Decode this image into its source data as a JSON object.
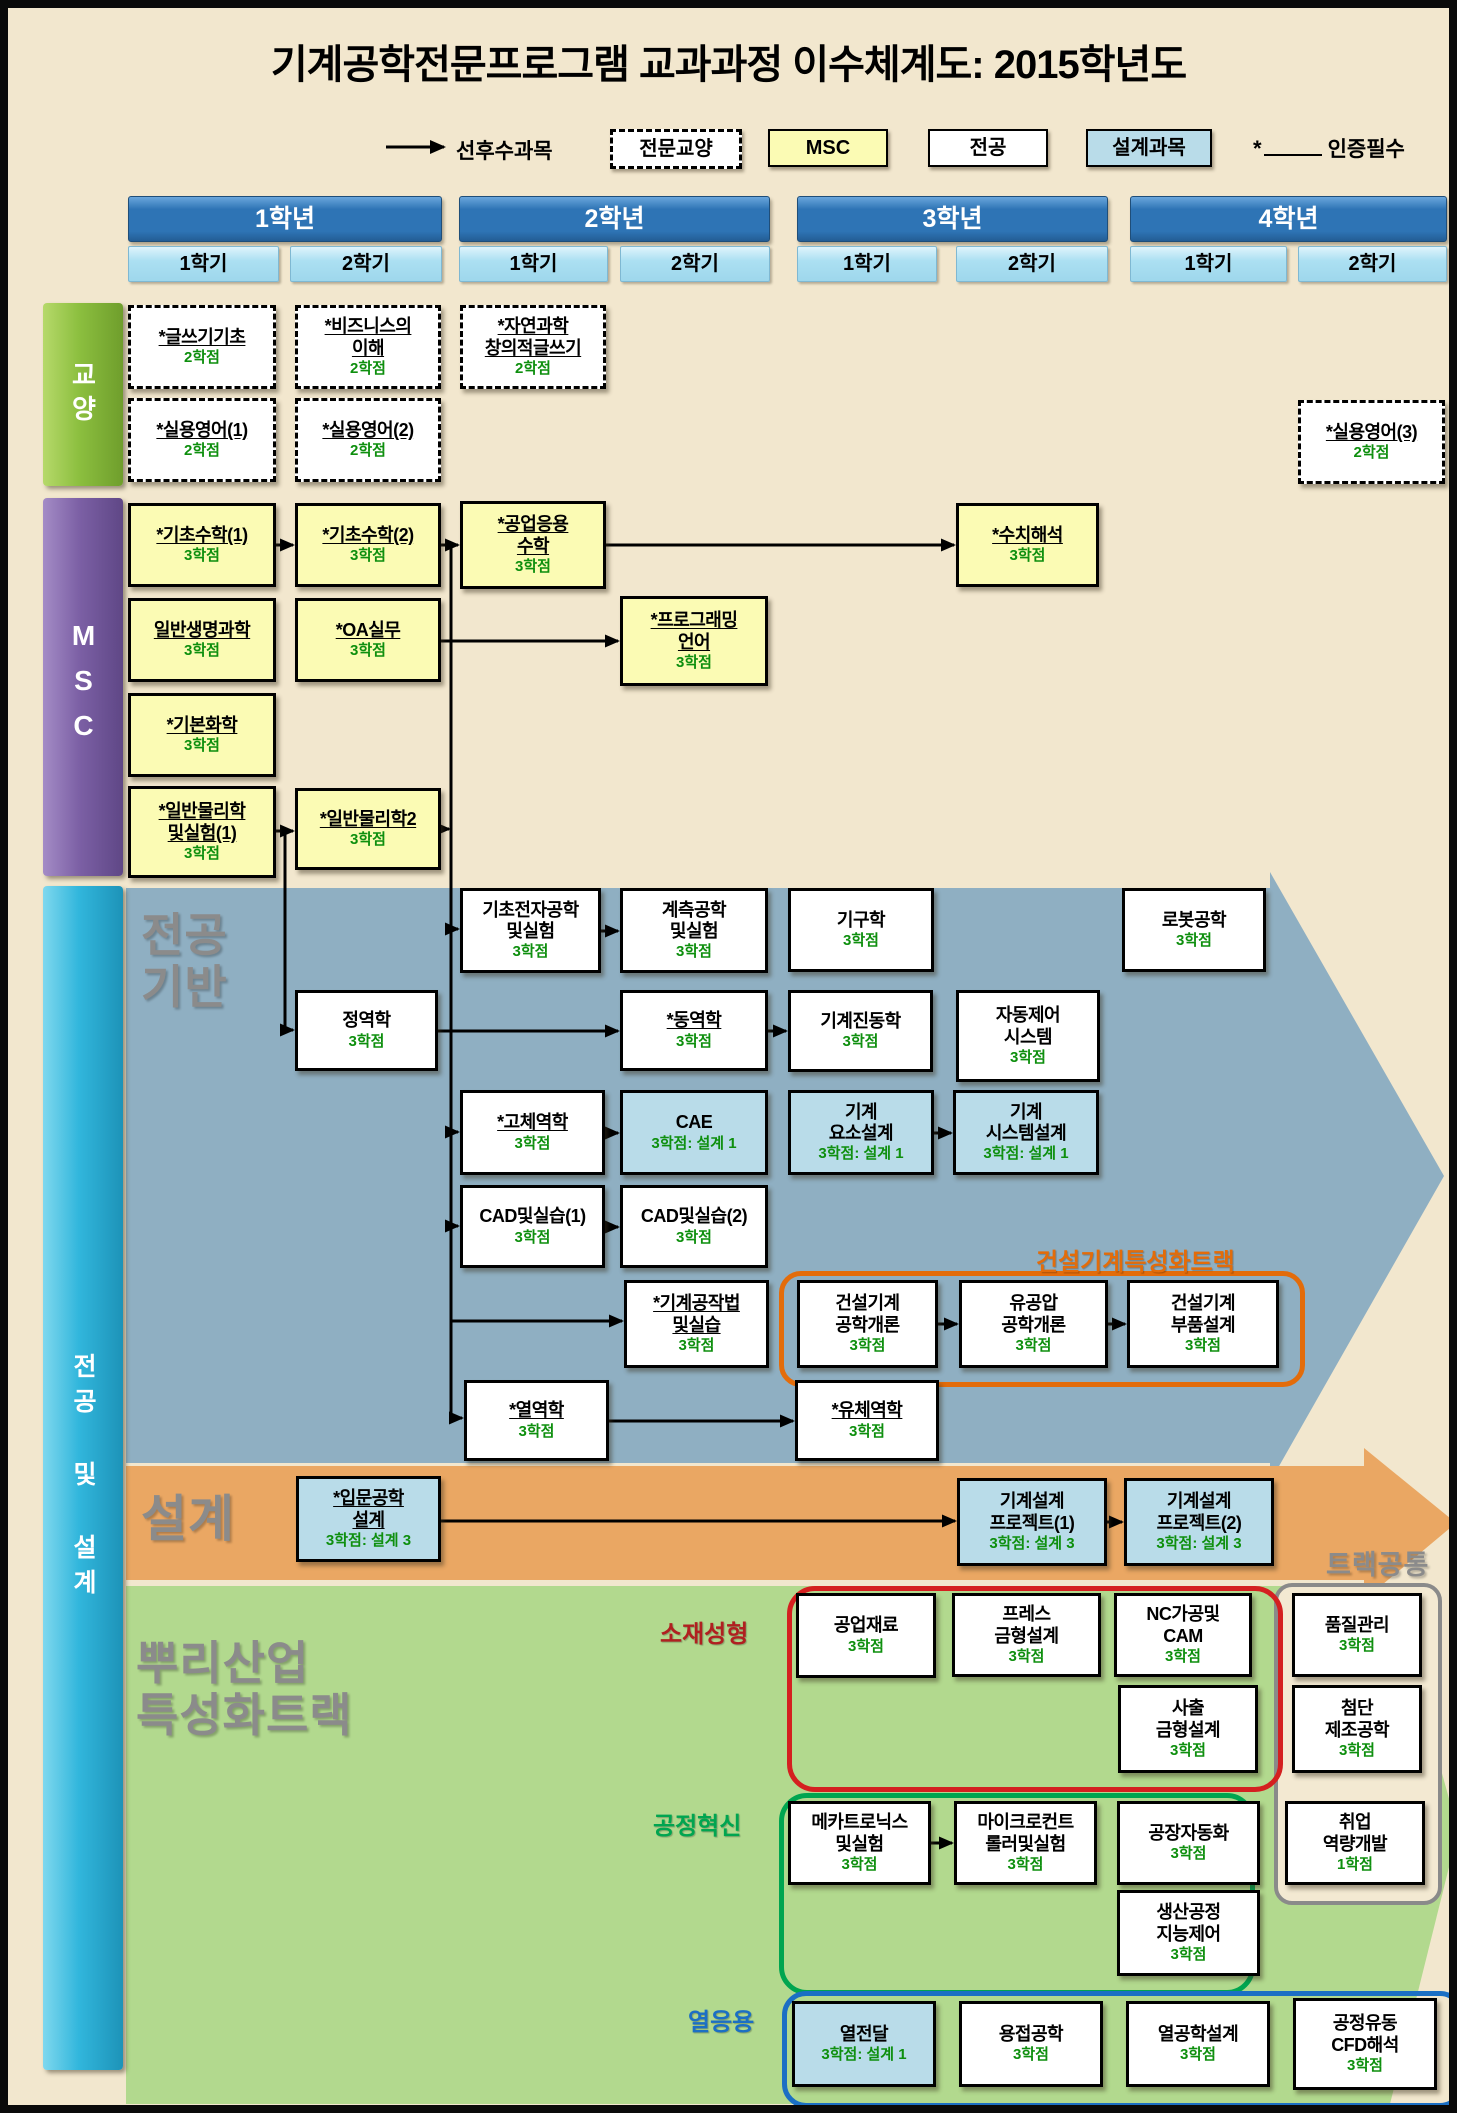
{
  "title": "기계공학전문프로그램 교과과정 이수체계도: 2015학년도",
  "legend": {
    "arrow_label": "선후수과목",
    "items": [
      {
        "id": "ge",
        "label": "전문교양"
      },
      {
        "id": "msc",
        "label": "MSC"
      },
      {
        "id": "major",
        "label": "전공"
      },
      {
        "id": "design",
        "label": "설계과목"
      }
    ],
    "certified_star": "*",
    "certified_label": "인증필수"
  },
  "header": {
    "y": 188,
    "h": 44,
    "sem_y": 238,
    "sem_h": 34,
    "years": [
      {
        "label": "1학년",
        "x": 120,
        "w": 312,
        "semesters": [
          {
            "label": "1학기",
            "x": 120,
            "w": 149
          },
          {
            "label": "2학기",
            "x": 282,
            "w": 150
          }
        ]
      },
      {
        "label": "2학년",
        "x": 451,
        "w": 309,
        "semesters": [
          {
            "label": "1학기",
            "x": 451,
            "w": 147
          },
          {
            "label": "2학기",
            "x": 612,
            "w": 148
          }
        ]
      },
      {
        "label": "3학년",
        "x": 789,
        "w": 309,
        "semesters": [
          {
            "label": "1학기",
            "x": 789,
            "w": 138
          },
          {
            "label": "2학기",
            "x": 948,
            "w": 150
          }
        ]
      },
      {
        "label": "4학년",
        "x": 1122,
        "w": 315,
        "semesters": [
          {
            "label": "1학기",
            "x": 1122,
            "w": 155
          },
          {
            "label": "2학기",
            "x": 1290,
            "w": 147
          }
        ]
      }
    ]
  },
  "sidebar": [
    {
      "id": "ge",
      "label": "교양",
      "x": 35,
      "y": 295,
      "h": 183
    },
    {
      "id": "msc",
      "label": "MSC",
      "x": 35,
      "y": 490,
      "h": 378
    },
    {
      "id": "major",
      "label": "전공 및 설계",
      "x": 35,
      "y": 878,
      "h": 1184
    }
  ],
  "section_labels": {
    "major_base": [
      "전공",
      "기반"
    ],
    "design": "설계",
    "root_track": [
      "뿌리산업",
      "특성화트랙"
    ]
  },
  "groups": {
    "const_track": {
      "label": "건설기계특성화트랙",
      "x": 771,
      "y": 1263,
      "w": 516,
      "h": 106,
      "label_x": 1028,
      "label_y": 1234
    },
    "material": {
      "label": "소재성형",
      "x": 779,
      "y": 1578,
      "w": 486,
      "h": 196,
      "label_x": 652,
      "label_y": 1606
    },
    "process": {
      "label": "공정혁신",
      "x": 771,
      "y": 1785,
      "w": 466,
      "h": 192,
      "label_x": 645,
      "label_y": 1798
    },
    "thermal": {
      "label": "열응용",
      "x": 774,
      "y": 1983,
      "w": 672,
      "h": 107,
      "label_x": 680,
      "label_y": 1994
    },
    "common": {
      "label": "트랙공통",
      "x": 1266,
      "y": 1575,
      "w": 160,
      "h": 314,
      "label_x": 1318,
      "label_y": 1542
    }
  },
  "courses": [
    {
      "id": "writing",
      "type": "ge",
      "cert": true,
      "name": [
        "*글쓰기기초"
      ],
      "credit": "2학점",
      "x": 120,
      "y": 297,
      "w": 148,
      "h": 84
    },
    {
      "id": "business",
      "type": "ge",
      "cert": true,
      "name": [
        "*비즈니스의",
        "이해"
      ],
      "credit": "2학점",
      "x": 287,
      "y": 297,
      "w": 146,
      "h": 84
    },
    {
      "id": "sciwriting",
      "type": "ge",
      "cert": true,
      "name": [
        "*자연과학",
        "창의적글쓰기"
      ],
      "credit": "2학점",
      "x": 452,
      "y": 297,
      "w": 146,
      "h": 84
    },
    {
      "id": "eng1",
      "type": "ge",
      "cert": true,
      "name": [
        "*실용영어(1)"
      ],
      "credit": "2학점",
      "x": 120,
      "y": 390,
      "w": 148,
      "h": 84
    },
    {
      "id": "eng2",
      "type": "ge",
      "cert": true,
      "name": [
        "*실용영어(2)"
      ],
      "credit": "2학점",
      "x": 287,
      "y": 390,
      "w": 146,
      "h": 84
    },
    {
      "id": "eng3",
      "type": "ge",
      "cert": true,
      "name": [
        "*실용영어(3)"
      ],
      "credit": "2학점",
      "x": 1290,
      "y": 392,
      "w": 147,
      "h": 84
    },
    {
      "id": "math1",
      "type": "msc",
      "cert": true,
      "name": [
        "*기초수학(1)"
      ],
      "credit": "3학점",
      "x": 120,
      "y": 495,
      "w": 148,
      "h": 84
    },
    {
      "id": "math2",
      "type": "msc",
      "cert": true,
      "name": [
        "*기초수학(2)"
      ],
      "credit": "3학점",
      "x": 287,
      "y": 495,
      "w": 146,
      "h": 84
    },
    {
      "id": "engmath",
      "type": "msc",
      "cert": true,
      "name": [
        "*공업응용",
        "수학"
      ],
      "credit": "3학점",
      "x": 452,
      "y": 493,
      "w": 146,
      "h": 88
    },
    {
      "id": "numerical",
      "type": "msc",
      "cert": true,
      "name": [
        "*수치해석"
      ],
      "credit": "3학점",
      "x": 948,
      "y": 495,
      "w": 143,
      "h": 84
    },
    {
      "id": "bio",
      "type": "msc",
      "cert": true,
      "name": [
        "일반생명과학"
      ],
      "credit": "3학점",
      "x": 120,
      "y": 590,
      "w": 148,
      "h": 84
    },
    {
      "id": "oa",
      "type": "msc",
      "cert": true,
      "name": [
        "*OA실무"
      ],
      "credit": "3학점",
      "x": 287,
      "y": 590,
      "w": 146,
      "h": 84
    },
    {
      "id": "programming",
      "type": "msc",
      "cert": true,
      "name": [
        "*프로그래밍",
        "언어"
      ],
      "credit": "3학점",
      "x": 612,
      "y": 588,
      "w": 148,
      "h": 90
    },
    {
      "id": "chem",
      "type": "msc",
      "cert": true,
      "name": [
        "*기본화학"
      ],
      "credit": "3학점",
      "x": 120,
      "y": 685,
      "w": 148,
      "h": 84
    },
    {
      "id": "phys1",
      "type": "msc",
      "cert": true,
      "name": [
        "*일반물리학",
        "및실험(1)"
      ],
      "credit": "3학점",
      "x": 120,
      "y": 778,
      "w": 148,
      "h": 92
    },
    {
      "id": "phys2",
      "type": "msc",
      "cert": true,
      "name": [
        "*일반물리학2"
      ],
      "credit": "3학점",
      "x": 287,
      "y": 780,
      "w": 146,
      "h": 82
    },
    {
      "id": "elec",
      "type": "major",
      "cert": false,
      "name": [
        "기초전자공학",
        "및실험"
      ],
      "credit": "3학점",
      "x": 452,
      "y": 880,
      "w": 141,
      "h": 85
    },
    {
      "id": "measure",
      "type": "major",
      "cert": false,
      "name": [
        "계측공학",
        "및실험"
      ],
      "credit": "3학점",
      "x": 612,
      "y": 880,
      "w": 148,
      "h": 85
    },
    {
      "id": "kinematics",
      "type": "major",
      "cert": false,
      "name": [
        "기구학"
      ],
      "credit": "3학점",
      "x": 780,
      "y": 880,
      "w": 146,
      "h": 84
    },
    {
      "id": "robot",
      "type": "major",
      "cert": false,
      "name": [
        "로봇공학"
      ],
      "credit": "3학점",
      "x": 1114,
      "y": 880,
      "w": 144,
      "h": 84
    },
    {
      "id": "statics",
      "type": "major",
      "cert": false,
      "name": [
        "정역학"
      ],
      "credit": "3학점",
      "x": 287,
      "y": 982,
      "w": 143,
      "h": 81
    },
    {
      "id": "dynamics",
      "type": "major",
      "cert": true,
      "name": [
        "*동역학"
      ],
      "credit": "3학점",
      "x": 612,
      "y": 982,
      "w": 148,
      "h": 81
    },
    {
      "id": "vibration",
      "type": "major",
      "cert": false,
      "name": [
        "기계진동학"
      ],
      "credit": "3학점",
      "x": 780,
      "y": 982,
      "w": 145,
      "h": 82
    },
    {
      "id": "autocontrol",
      "type": "major",
      "cert": false,
      "name": [
        "자동제어",
        "시스템"
      ],
      "credit": "3학점",
      "x": 948,
      "y": 982,
      "w": 144,
      "h": 92
    },
    {
      "id": "solid",
      "type": "major",
      "cert": true,
      "name": [
        "*고체역학"
      ],
      "credit": "3학점",
      "x": 452,
      "y": 1082,
      "w": 145,
      "h": 85
    },
    {
      "id": "cae",
      "type": "design",
      "cert": false,
      "name": [
        "CAE"
      ],
      "credit": "3학점: 설계 1",
      "x": 612,
      "y": 1082,
      "w": 148,
      "h": 85
    },
    {
      "id": "elements",
      "type": "design",
      "cert": false,
      "name": [
        "기계",
        "요소설계"
      ],
      "credit": "3학점: 설계 1",
      "x": 780,
      "y": 1082,
      "w": 146,
      "h": 85
    },
    {
      "id": "system",
      "type": "design",
      "cert": false,
      "name": [
        "기계",
        "시스템설계"
      ],
      "credit": "3학점: 설계 1",
      "x": 945,
      "y": 1082,
      "w": 146,
      "h": 85
    },
    {
      "id": "cad1",
      "type": "major",
      "cert": false,
      "name": [
        "CAD및실습(1)"
      ],
      "credit": "3학점",
      "x": 452,
      "y": 1177,
      "w": 145,
      "h": 83
    },
    {
      "id": "cad2",
      "type": "major",
      "cert": false,
      "name": [
        "CAD및실습(2)"
      ],
      "credit": "3학점",
      "x": 612,
      "y": 1177,
      "w": 148,
      "h": 83
    },
    {
      "id": "shop",
      "type": "major",
      "cert": true,
      "name": [
        "*기계공작법",
        "및실습"
      ],
      "credit": "3학점",
      "x": 616,
      "y": 1272,
      "w": 145,
      "h": 88
    },
    {
      "id": "constintro",
      "type": "major",
      "cert": false,
      "name": [
        "건설기계",
        "공학개론"
      ],
      "credit": "3학점",
      "x": 789,
      "y": 1272,
      "w": 141,
      "h": 88
    },
    {
      "id": "hydraulic",
      "type": "major",
      "cert": false,
      "name": [
        "유공압",
        "공학개론"
      ],
      "credit": "3학점",
      "x": 951,
      "y": 1272,
      "w": 149,
      "h": 88
    },
    {
      "id": "constparts",
      "type": "major",
      "cert": false,
      "name": [
        "건설기계",
        "부품설계"
      ],
      "credit": "3학점",
      "x": 1119,
      "y": 1272,
      "w": 152,
      "h": 88
    },
    {
      "id": "thermo",
      "type": "major",
      "cert": true,
      "name": [
        "*열역학"
      ],
      "credit": "3학점",
      "x": 456,
      "y": 1372,
      "w": 145,
      "h": 81
    },
    {
      "id": "fluid",
      "type": "major",
      "cert": true,
      "name": [
        "*유체역학"
      ],
      "credit": "3학점",
      "x": 787,
      "y": 1372,
      "w": 144,
      "h": 81
    },
    {
      "id": "introdesign",
      "type": "design",
      "cert": true,
      "name": [
        "*입문공학",
        "설계"
      ],
      "credit": "3학점: 설계 3",
      "x": 288,
      "y": 1468,
      "w": 145,
      "h": 86
    },
    {
      "id": "proj1",
      "type": "design",
      "cert": false,
      "name": [
        "기계설계",
        "프로젝트(1)"
      ],
      "credit": "3학점: 설계 3",
      "x": 949,
      "y": 1470,
      "w": 150,
      "h": 88
    },
    {
      "id": "proj2",
      "type": "design",
      "cert": false,
      "name": [
        "기계설계",
        "프로젝트(2)"
      ],
      "credit": "3학점: 설계 3",
      "x": 1116,
      "y": 1470,
      "w": 150,
      "h": 88
    },
    {
      "id": "indmat",
      "type": "major",
      "cert": false,
      "name": [
        "공업재료"
      ],
      "credit": "3학점",
      "x": 788,
      "y": 1585,
      "w": 140,
      "h": 85
    },
    {
      "id": "press",
      "type": "major",
      "cert": false,
      "name": [
        "프레스",
        "금형설계"
      ],
      "credit": "3학점",
      "x": 944,
      "y": 1585,
      "w": 149,
      "h": 84
    },
    {
      "id": "nccam",
      "type": "major",
      "cert": false,
      "name": [
        "NC가공및",
        "CAM"
      ],
      "credit": "3학점",
      "x": 1106,
      "y": 1585,
      "w": 138,
      "h": 84
    },
    {
      "id": "injection",
      "type": "major",
      "cert": false,
      "name": [
        "사출",
        "금형설계"
      ],
      "credit": "3학점",
      "x": 1110,
      "y": 1677,
      "w": 140,
      "h": 88
    },
    {
      "id": "quality",
      "type": "major",
      "cert": false,
      "name": [
        "품질관리"
      ],
      "credit": "3학점",
      "x": 1284,
      "y": 1585,
      "w": 130,
      "h": 84
    },
    {
      "id": "advmfg",
      "type": "major",
      "cert": false,
      "name": [
        "첨단",
        "제조공학"
      ],
      "credit": "3학점",
      "x": 1284,
      "y": 1677,
      "w": 130,
      "h": 88
    },
    {
      "id": "career",
      "type": "major",
      "cert": false,
      "name": [
        "취업",
        "역량개발"
      ],
      "credit": "1학점",
      "x": 1277,
      "y": 1793,
      "w": 140,
      "h": 84
    },
    {
      "id": "mecha",
      "type": "major",
      "cert": false,
      "name": [
        "메카트로닉스",
        "및실험"
      ],
      "credit": "3학점",
      "x": 780,
      "y": 1793,
      "w": 143,
      "h": 84
    },
    {
      "id": "micro",
      "type": "major",
      "cert": false,
      "name": [
        "마이크로컨트",
        "롤러및실험"
      ],
      "credit": "3학점",
      "x": 946,
      "y": 1793,
      "w": 143,
      "h": 84
    },
    {
      "id": "factory",
      "type": "major",
      "cert": false,
      "name": [
        "공장자동화"
      ],
      "credit": "3학점",
      "x": 1109,
      "y": 1793,
      "w": 143,
      "h": 84
    },
    {
      "id": "prodctrl",
      "type": "major",
      "cert": false,
      "name": [
        "생산공정",
        "지능제어"
      ],
      "credit": "3학점",
      "x": 1109,
      "y": 1882,
      "w": 143,
      "h": 86
    },
    {
      "id": "heattrans",
      "type": "design",
      "cert": false,
      "name": [
        "열전달"
      ],
      "credit": "3학점: 설계 1",
      "x": 784,
      "y": 1993,
      "w": 144,
      "h": 86
    },
    {
      "id": "welding",
      "type": "major",
      "cert": false,
      "name": [
        "용접공학"
      ],
      "credit": "3학점",
      "x": 951,
      "y": 1993,
      "w": 144,
      "h": 86
    },
    {
      "id": "thermdesign",
      "type": "major",
      "cert": false,
      "name": [
        "열공학설계"
      ],
      "credit": "3학점",
      "x": 1118,
      "y": 1993,
      "w": 144,
      "h": 86
    },
    {
      "id": "cfd",
      "type": "major",
      "cert": false,
      "name": [
        "공정유동",
        "CFD해석"
      ],
      "credit": "3학점",
      "x": 1285,
      "y": 1990,
      "w": 144,
      "h": 92
    }
  ],
  "arrows": [
    [
      "math1",
      "math2"
    ],
    [
      "math2",
      "engmath"
    ],
    [
      "engmath",
      "numerical"
    ],
    [
      "oa",
      "programming"
    ],
    [
      "phys1",
      "phys2"
    ],
    [
      "elec",
      "measure"
    ],
    [
      "statics",
      "dynamics"
    ],
    [
      "dynamics",
      "vibration"
    ],
    [
      "solid",
      "cae"
    ],
    [
      "elements",
      "system"
    ],
    [
      "cad1",
      "cad2"
    ],
    [
      "constintro",
      "hydraulic"
    ],
    [
      "hydraulic",
      "constparts"
    ],
    [
      "thermo",
      "fluid"
    ],
    [
      "introdesign",
      "proj1"
    ],
    [
      "proj1",
      "proj2"
    ],
    [
      "mecha",
      "micro"
    ]
  ],
  "flow_lines": [
    {
      "points": [
        [
          443,
          537
        ],
        [
          443,
          1410
        ]
      ],
      "arrow": false
    },
    {
      "points": [
        [
          443,
          921
        ],
        [
          450,
          921
        ]
      ],
      "arrow": true
    },
    {
      "points": [
        [
          443,
          1124
        ],
        [
          450,
          1124
        ]
      ],
      "arrow": true
    },
    {
      "points": [
        [
          443,
          1218
        ],
        [
          450,
          1218
        ]
      ],
      "arrow": true
    },
    {
      "points": [
        [
          443,
          1313
        ],
        [
          614,
          1313
        ]
      ],
      "arrow": true
    },
    {
      "points": [
        [
          443,
          1410
        ],
        [
          454,
          1410
        ]
      ],
      "arrow": true
    },
    {
      "points": [
        [
          433,
          821
        ],
        [
          441,
          821
        ]
      ],
      "arrow": true
    },
    {
      "points": [
        [
          277,
          821
        ],
        [
          277,
          1022
        ],
        [
          285,
          1022
        ]
      ],
      "arrow": true
    }
  ],
  "colors": {
    "background": "#F2E7CE",
    "year_header": "#2E74B5",
    "semester": "#ACE0F2",
    "msc_box": "#FBFBB4",
    "design_box": "#B9DCE9",
    "credit_green": "#0E8F0E",
    "major_flow_arrow": "#8FAFC2",
    "design_flow_arrow": "#EAA763",
    "track_flow_arrow": "#B2D98E",
    "const_track_orange": "#E36C0A",
    "material_red": "#D42020",
    "process_green": "#00A550",
    "thermal_blue": "#1B6FC4",
    "common_gray": "#8A8A8A",
    "ge_bar": "#8CBF3F",
    "msc_bar": "#7C60A5",
    "major_bar": "#31B6DC"
  }
}
